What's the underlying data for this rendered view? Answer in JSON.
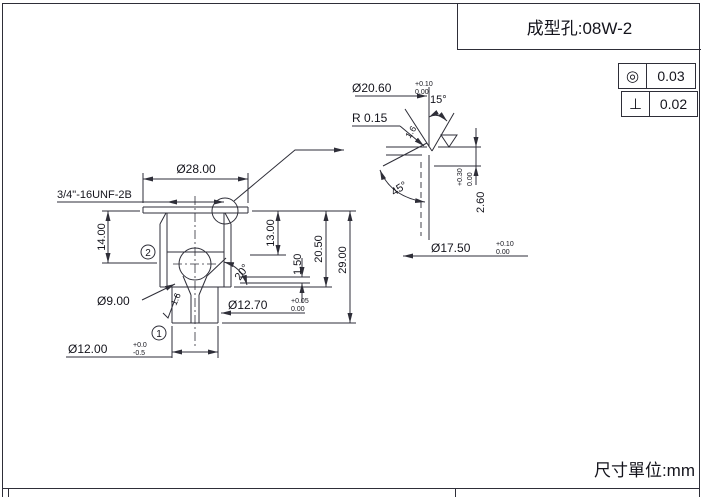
{
  "title_block": {
    "part_no": "成型孔:08W-2"
  },
  "footer": {
    "units_label": "尺寸單位:mm"
  },
  "tolerance_frames": [
    {
      "name": "concentricity",
      "symbol": "◎",
      "value": "0.03"
    },
    {
      "name": "perpendicularity",
      "symbol": "⊥",
      "value": "0.02"
    }
  ],
  "main_view": {
    "balloons": [
      "1",
      "2"
    ],
    "dims": {
      "flange_dia": "Ø28.00",
      "thread": "3/4\"-16UNF-2B",
      "h14": "14.00",
      "h13": "13.00",
      "h1_5": "1.50",
      "h20_5": "20.50",
      "h29": "29.00",
      "ball_dia": "Ø9.00",
      "cone_angle": "20°",
      "bore_dia_nom": "Ø12.70",
      "bore_dia_tol_up": "+0.05",
      "bore_dia_tol_lo": "0.00",
      "stem_dia_nom": "Ø12.00",
      "stem_dia_tol_up": "+0.0",
      "stem_dia_tol_lo": "-0.5",
      "roughness": "1.6"
    }
  },
  "detail_view": {
    "dims": {
      "top_dia_nom": "Ø20.60",
      "top_dia_tol_up": "+0.10",
      "top_dia_tol_lo": "0.00",
      "seat_angle": "15°",
      "radius": "R 0.15",
      "roughness_seat": "1.6",
      "roughness_chamfer": "3.2",
      "chamfer_angle": "45°",
      "depth_nom": "2.60",
      "depth_tol_up": "+0.30",
      "depth_tol_lo": "0.00",
      "bottom_dia_nom": "Ø17.50",
      "bottom_dia_tol_up": "+0.10",
      "bottom_dia_tol_lo": "0.00"
    }
  }
}
